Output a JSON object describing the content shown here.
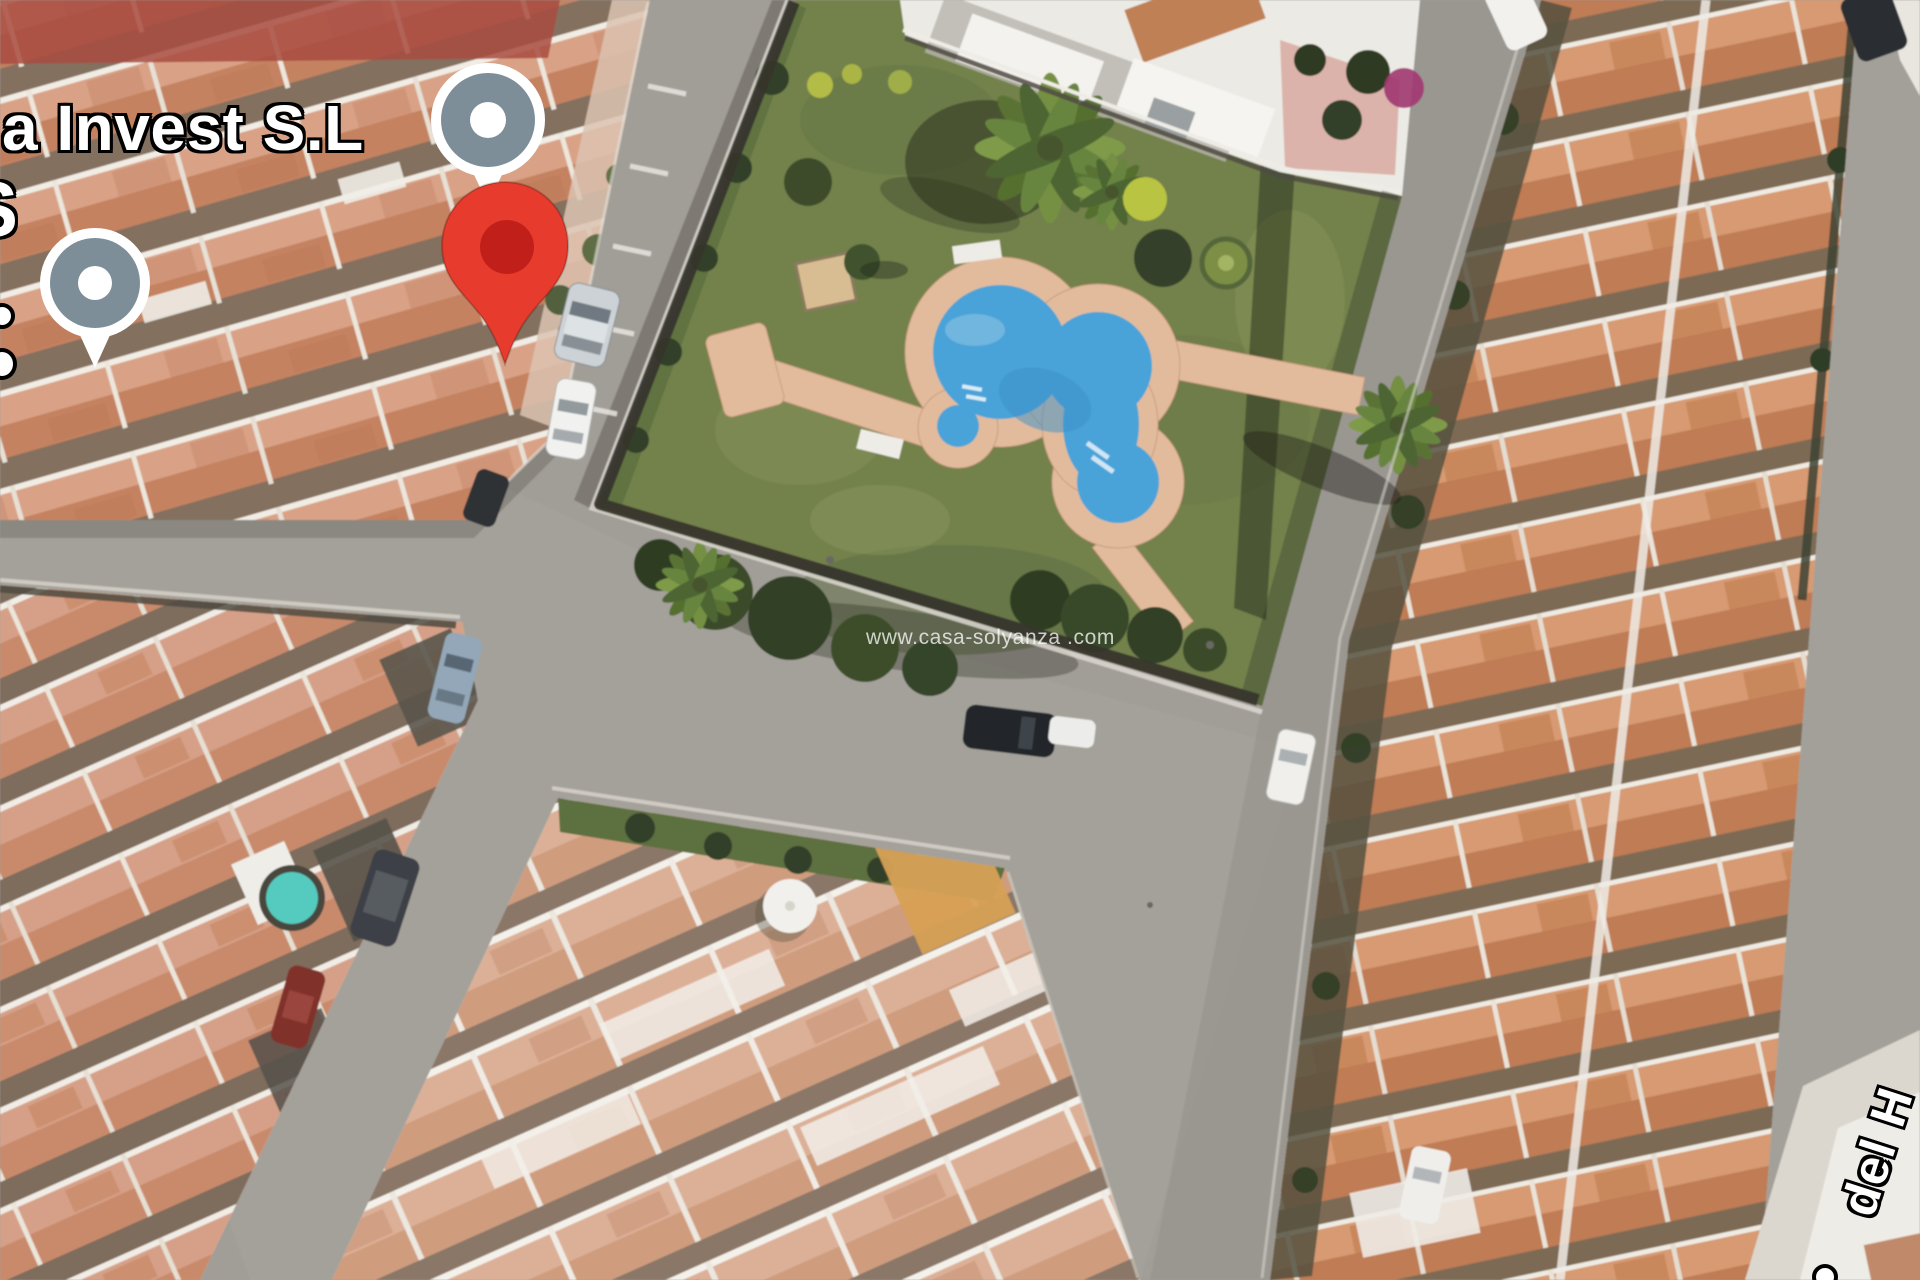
{
  "map_overlay": {
    "poi_label": "a Invest S.L",
    "partial_edge_label": "S",
    "street_label": "del H",
    "watermark": "www.casa-solyanza .com"
  },
  "markers": {
    "destination_pin": {
      "fill": "#e63b2d",
      "dot": "#c1201a",
      "outline": "#c63325"
    },
    "poi_marker": {
      "body": "#ffffff",
      "ring": "#7e8e98",
      "dot": "#ffffff"
    }
  },
  "scene_colors": {
    "asphalt": "#a19d97",
    "grass": "#73814c",
    "pool_water": "#4aa3d8",
    "pool_deck": "#e2bb9d",
    "roof_terracotta": "#cf9478"
  }
}
